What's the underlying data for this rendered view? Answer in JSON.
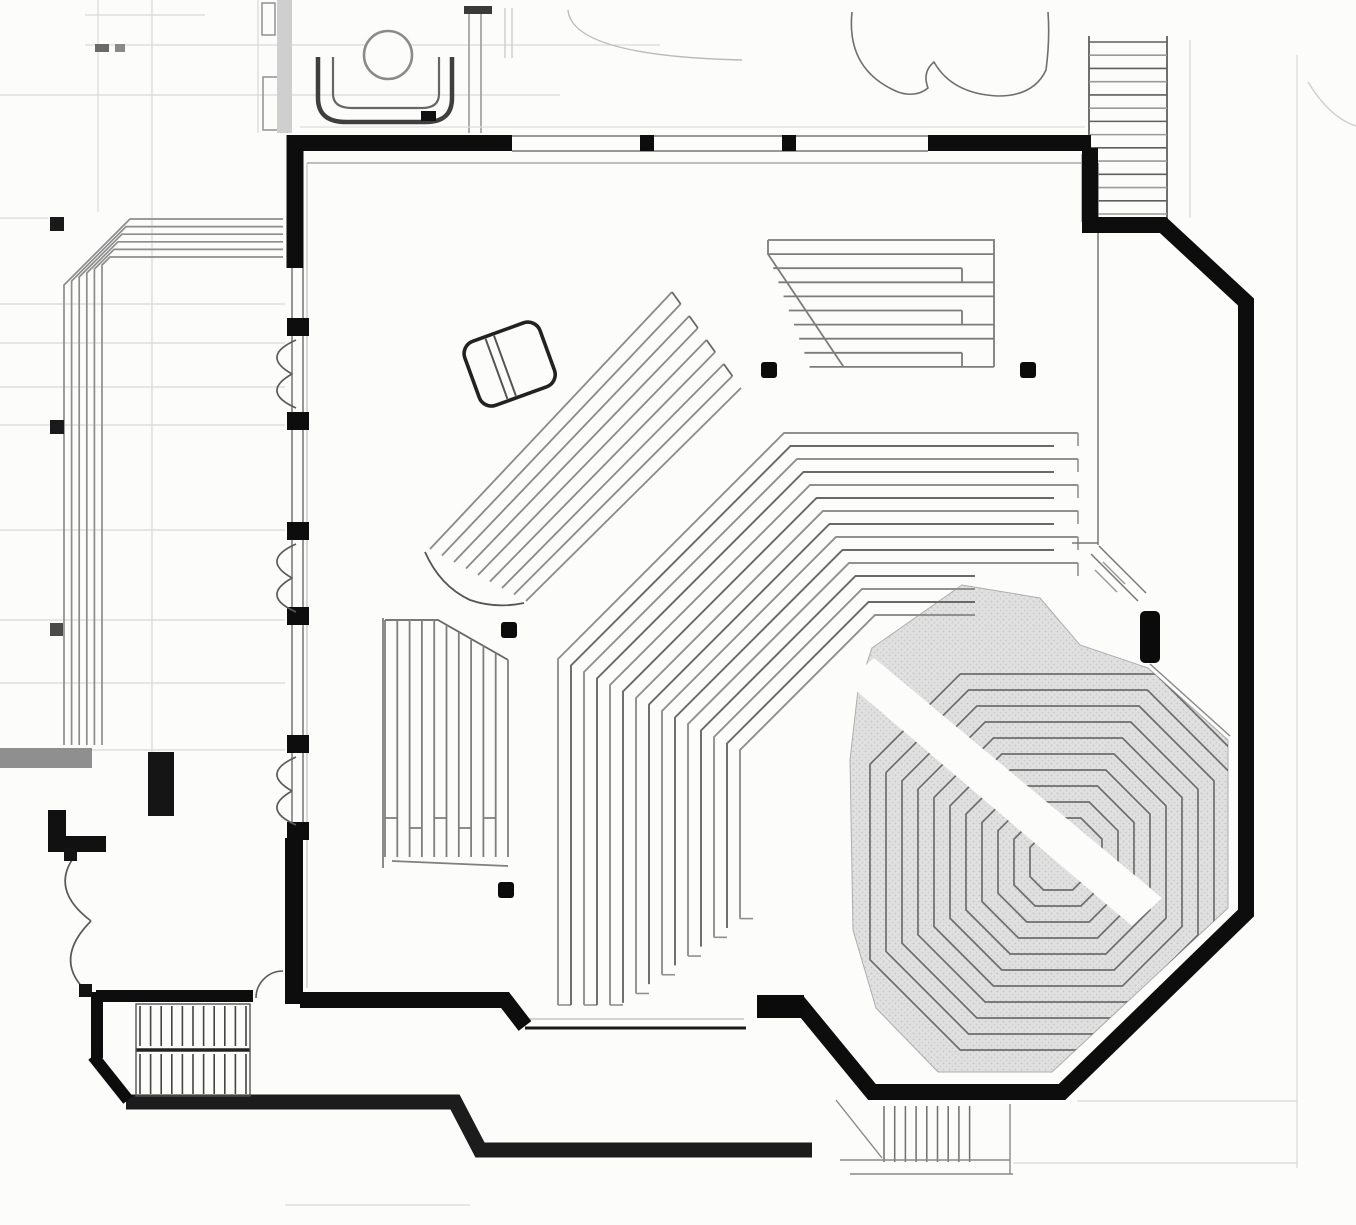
{
  "meta": {
    "title": "architectural-floor-plan",
    "subject": "church-sanctuary-plan-with-radial-seating",
    "visible_text": []
  },
  "palette": {
    "bg": "#fcfcfb",
    "wall": "#0d0d0d",
    "black": "#0b0b0b",
    "line_dark": "#555555",
    "line_mid": "#8a8a8a",
    "line_light": "#b5b5b5",
    "faint": "#d9d9d9",
    "stage_fill": "#e0e0e0",
    "stage_dot": "#c4c4c4",
    "gray_stub": "#8f8f8f"
  },
  "plan": {
    "canvas": {
      "w": 1356,
      "h": 1225
    },
    "main_rings": {
      "cx": 1010,
      "cy": 885,
      "r_min": 270,
      "step": 13,
      "count": 15,
      "k": 0.5,
      "bottom_y": 1005,
      "bottom_bend_x": 620,
      "bottom_slope": 0.72,
      "end_x": 1078,
      "end_stagger": 24,
      "inner_end_x": 975,
      "inner_end_ymin": 575
    },
    "stage": {
      "poly": "872,648 962,585 1040,598 1080,645 1148,668 1228,740 1228,908 1052,1072 938,1072 876,1008 853,930 850,760 858,690",
      "aisle": "846,682 874,658 1162,898 1132,926",
      "rings": {
        "cx": 1058,
        "cy": 862,
        "k": 0.52,
        "radii": [
          28,
          44,
          60,
          76,
          92,
          108,
          124,
          140,
          156,
          172,
          188
        ]
      }
    },
    "balcony_block": {
      "rows": 10,
      "y0": 240,
      "dy": 14.1,
      "x_left": 768,
      "left_step": 5.2,
      "x_right": 994,
      "notch_x": 962
    },
    "fan_block": {
      "rows": 9,
      "start_a": [
        430,
        549
      ],
      "start_b": [
        526,
        601
      ],
      "end_a": [
        672,
        292
      ],
      "end_b": [
        741,
        388
      ]
    },
    "left_block": {
      "cols": 11,
      "x0": 385,
      "dx": 12.3,
      "y_top": 620,
      "bend_x": 438,
      "bend_slope": 0.57,
      "y_bottom": 857,
      "conn_y": 818
    },
    "terrace": {
      "count": 6,
      "y0": 219,
      "dy": 7.6,
      "x_right": 283,
      "x_turn": 130,
      "turn_step": 4,
      "xv": 64,
      "dxv": 7.6,
      "y_bottom": 745
    },
    "stairs_ne": {
      "x0": 1089,
      "x1": 1167,
      "y0": 42,
      "y1": 214,
      "treads": 14
    },
    "stairs_sw": {
      "x0": 140,
      "x1": 246,
      "cols": 11,
      "flight1": [
        1006,
        1046
      ],
      "flight2": [
        1054,
        1094
      ],
      "rail_y": 1050
    },
    "stairs_s": {
      "x0": 884,
      "dx": 10.7,
      "count": 9,
      "y0": 1106,
      "y1": 1162
    },
    "columns": [
      [
        761,
        362
      ],
      [
        1020,
        362
      ],
      [
        501,
        622
      ],
      [
        498,
        882
      ]
    ],
    "column_size": 16,
    "doors_left": {
      "x": 296,
      "sets": [
        336,
        540,
        753
      ],
      "span": 76,
      "pier_ys": [
        318,
        412,
        522,
        607,
        735,
        822
      ],
      "pier_h": 18
    },
    "faint_h": [
      [
        85,
        15,
        205
      ],
      [
        85,
        45,
        660
      ],
      [
        0,
        95,
        560
      ],
      [
        0,
        218,
        48
      ],
      [
        0,
        304,
        285
      ],
      [
        0,
        343,
        285
      ],
      [
        0,
        387,
        285
      ],
      [
        0,
        425,
        285
      ],
      [
        0,
        530,
        285
      ],
      [
        0,
        620,
        285
      ],
      [
        0,
        683,
        285
      ],
      [
        0,
        750,
        285
      ],
      [
        1077,
        1101,
        1297
      ],
      [
        1013,
        1163,
        1297
      ],
      [
        285,
        1205,
        470
      ]
    ],
    "faint_v": [
      [
        152,
        0,
        752
      ],
      [
        258,
        0,
        133
      ],
      [
        98,
        0,
        212
      ],
      [
        1297,
        55,
        1168
      ],
      [
        1190,
        40,
        218
      ]
    ]
  }
}
